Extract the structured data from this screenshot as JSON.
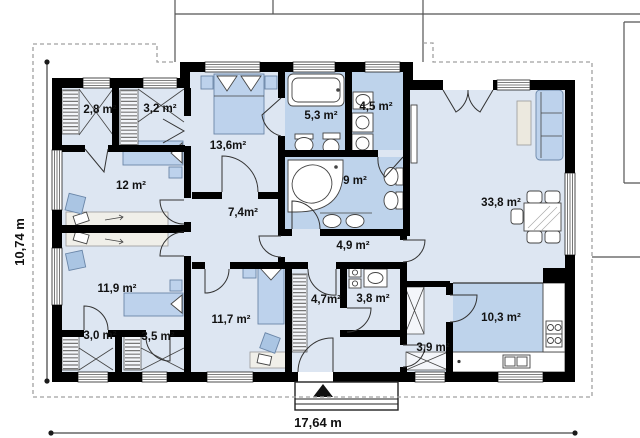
{
  "plan": {
    "title": "single-storey house floor plan",
    "rooms": [
      {
        "id": "closet-top-left",
        "label": "2,8 m²"
      },
      {
        "id": "closet-top-right",
        "label": "3,2 m²"
      },
      {
        "id": "bedroom-double",
        "label": "13,6m²"
      },
      {
        "id": "bathroom-small",
        "label": "5,3 m²"
      },
      {
        "id": "utility-room",
        "label": "4,5 m²"
      },
      {
        "id": "bedroom-left",
        "label": "12 m²"
      },
      {
        "id": "bathroom-main",
        "label": "9 m²"
      },
      {
        "id": "living-room",
        "label": "33,8 m²"
      },
      {
        "id": "hall",
        "label": "7,4m²"
      },
      {
        "id": "corridor",
        "label": "4,9 m²"
      },
      {
        "id": "bedroom-bottom-left",
        "label": "11,9 m²"
      },
      {
        "id": "bedroom-bottom-middle",
        "label": "11,7 m²"
      },
      {
        "id": "entry-hall",
        "label": "4,7m²"
      },
      {
        "id": "wc",
        "label": "3,8 m²"
      },
      {
        "id": "closet-bottom-left",
        "label": "3,0 m²"
      },
      {
        "id": "closet-bottom-right",
        "label": "3,5 m²"
      },
      {
        "id": "kitchen",
        "label": "10,3 m²"
      },
      {
        "id": "pantry",
        "label": "3,9 m²"
      }
    ],
    "dimensions": {
      "width_label": "17,64 m",
      "height_label": "10,74 m"
    },
    "colors": {
      "floor_light": "#dde6f2",
      "floor_wet": "#bed3eb",
      "wall": "#000000",
      "furniture_blue": "#bdd2ec",
      "roof_outline_dashed": "#a0a0a0"
    }
  }
}
